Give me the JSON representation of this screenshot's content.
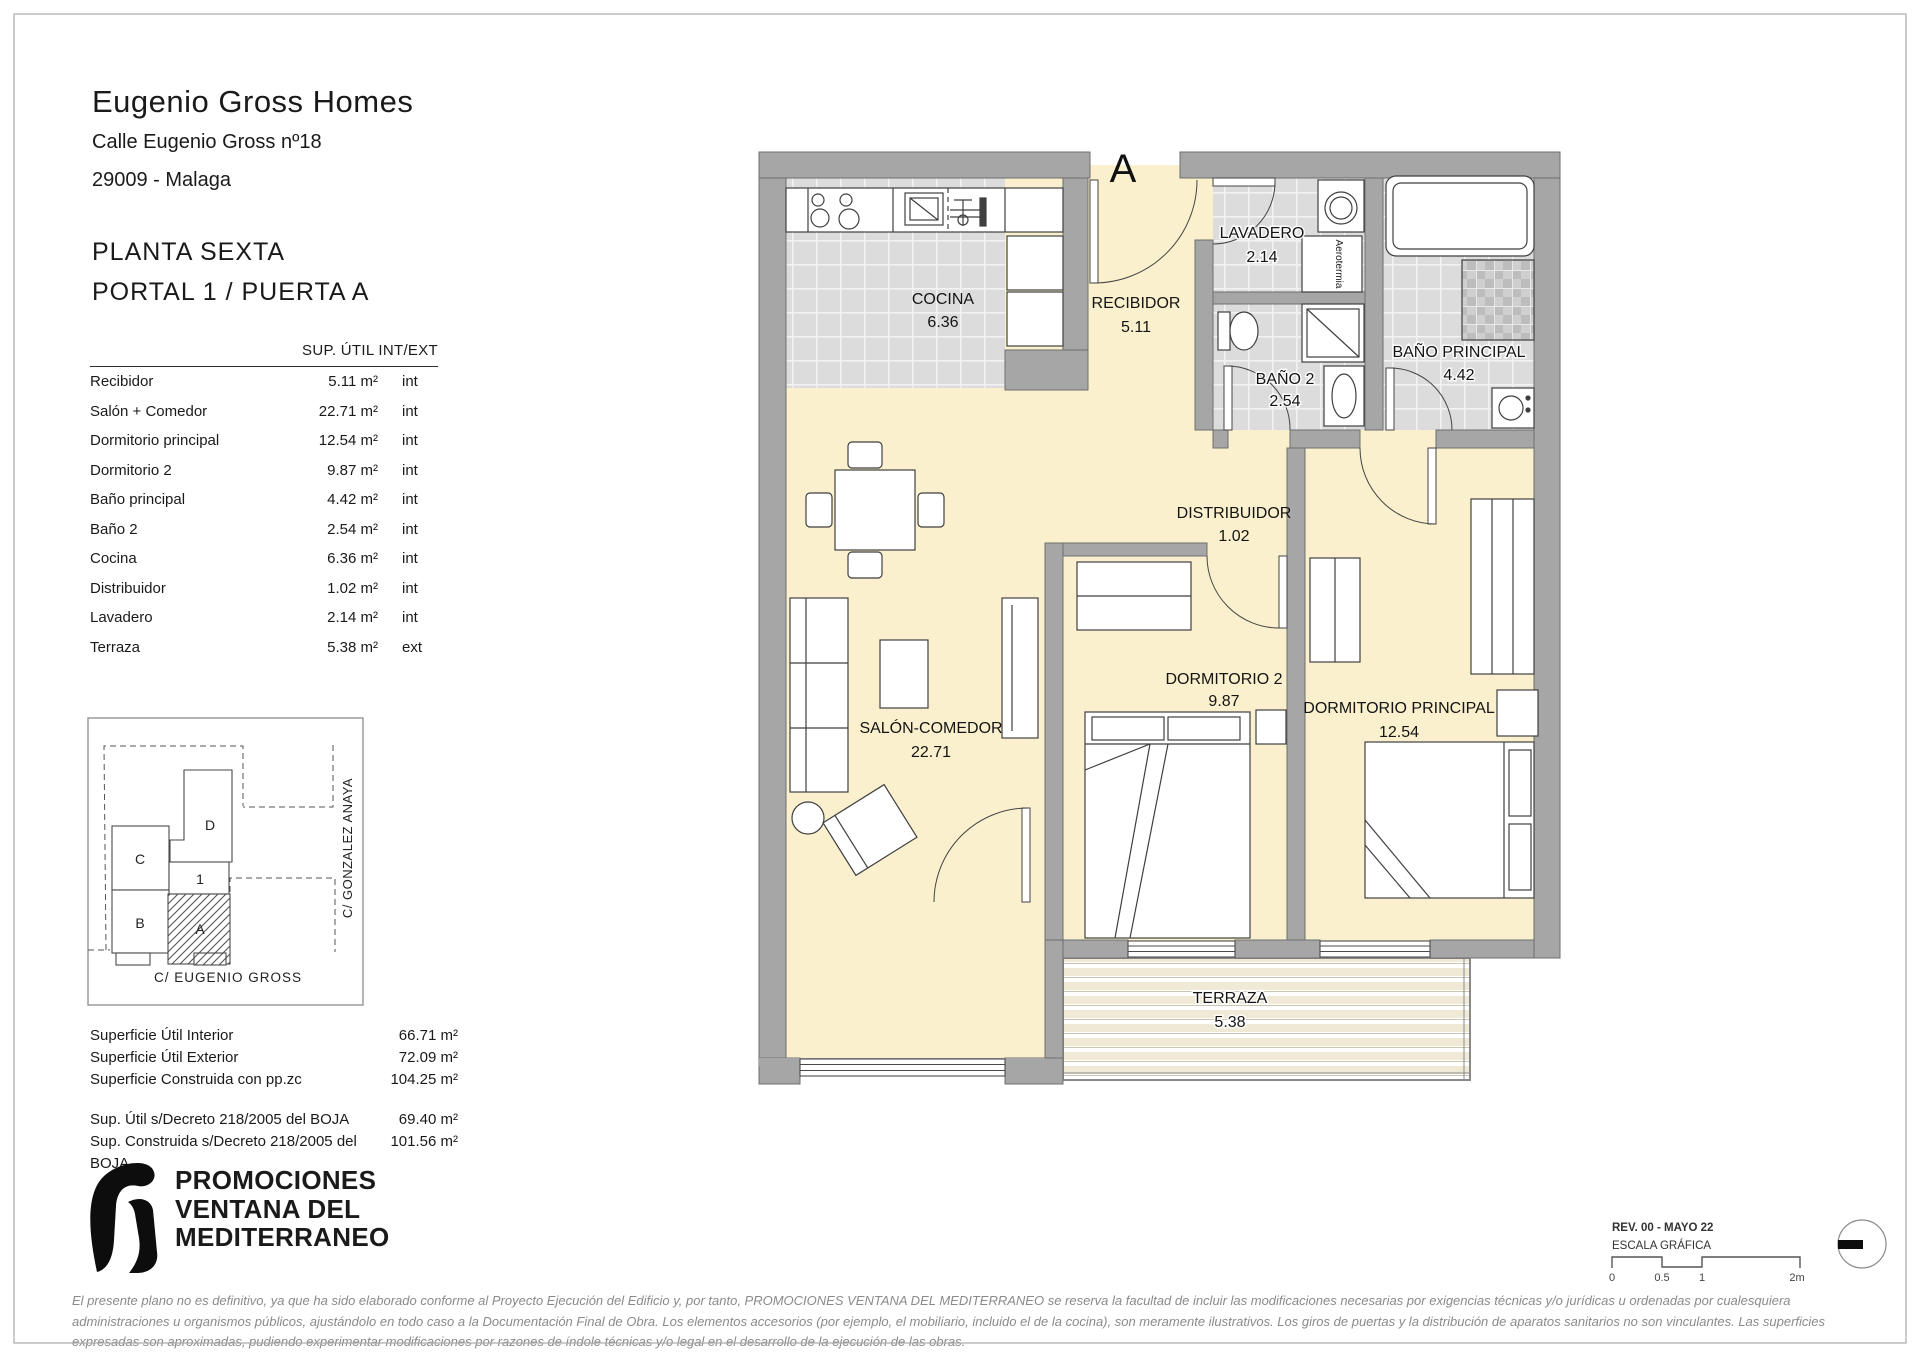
{
  "project": {
    "name": "Eugenio Gross Homes",
    "address": "Calle Eugenio Gross nº18",
    "city": "29009 - Malaga",
    "floor": "PLANTA SEXTA",
    "unit": "PORTAL 1 / PUERTA A"
  },
  "areas_table": {
    "header": "SUP. ÚTIL INT/EXT",
    "rows": [
      {
        "label": "Recibidor",
        "value": "5.11 m²",
        "type": "int"
      },
      {
        "label": "Salón + Comedor",
        "value": "22.71 m²",
        "type": "int"
      },
      {
        "label": "Dormitorio principal",
        "value": "12.54 m²",
        "type": "int"
      },
      {
        "label": "Dormitorio 2",
        "value": "9.87 m²",
        "type": "int"
      },
      {
        "label": "Baño principal",
        "value": "4.42 m²",
        "type": "int"
      },
      {
        "label": "Baño 2",
        "value": "2.54 m²",
        "type": "int"
      },
      {
        "label": "Cocina",
        "value": "6.36 m²",
        "type": "int"
      },
      {
        "label": "Distribuidor",
        "value": "1.02 m²",
        "type": "int"
      },
      {
        "label": "Lavadero",
        "value": "2.14 m²",
        "type": "int"
      },
      {
        "label": "Terraza",
        "value": "5.38 m²",
        "type": "ext"
      }
    ]
  },
  "site_plan": {
    "street_right": "C/ GONZALEZ ANAYA",
    "street_bottom": "C/ EUGENIO GROSS",
    "unit_d": "D",
    "unit_c": "C",
    "unit_1": "1",
    "unit_b": "B",
    "unit_a": "A"
  },
  "summary": {
    "rows": [
      {
        "label": "Superficie Útil Interior",
        "value": "66.71 m²"
      },
      {
        "label": "Superficie Útil Exterior",
        "value": "72.09 m²"
      },
      {
        "label": "Superficie Construida con pp.zc",
        "value": "104.25 m²"
      }
    ],
    "boja_rows": [
      {
        "label": "Sup. Útil s/Decreto 218/2005 del BOJA",
        "value": "69.40 m²"
      },
      {
        "label": "Sup. Construida s/Decreto 218/2005 del BOJA",
        "value": "101.56 m²"
      }
    ]
  },
  "developer": {
    "line1": "PROMOCIONES",
    "line2": "VENTANA DEL",
    "line3": "MEDITERRANEO"
  },
  "plan": {
    "entrance": "A",
    "aerotermia": "Aerotermia",
    "rooms": {
      "cocina": {
        "name": "COCINA",
        "area": "6.36"
      },
      "recibidor": {
        "name": "RECIBIDOR",
        "area": "5.11"
      },
      "lavadero": {
        "name": "LAVADERO",
        "area": "2.14"
      },
      "banop": {
        "name": "BAÑO PRINCIPAL",
        "area": "4.42"
      },
      "bano2": {
        "name": "BAÑO 2",
        "area": "2.54"
      },
      "distribuidor": {
        "name": "DISTRIBUIDOR",
        "area": "1.02"
      },
      "salon": {
        "name": "SALÓN-COMEDOR",
        "area": "22.71"
      },
      "dorm2": {
        "name": "DORMITORIO 2",
        "area": "9.87"
      },
      "dormp": {
        "name": "DORMITORIO PRINCIPAL",
        "area": "12.54"
      },
      "terraza": {
        "name": "TERRAZA",
        "area": "5.38"
      }
    }
  },
  "titleblock": {
    "revision": "REV. 00 - MAYO 22",
    "scale_label": "ESCALA GRÁFICA",
    "tick0": "0",
    "tick05": "0.5",
    "tick1": "1",
    "tick2": "2m"
  },
  "colors": {
    "floor_cream": "#faf0cd",
    "wall_gray": "#a6a6a6",
    "tile_gray": "#dcdcdc"
  },
  "disclaimer": "El presente plano no es definitivo, ya que ha sido elaborado conforme al Proyecto Ejecución del Edificio y, por tanto, PROMOCIONES VENTANA DEL MEDITERRANEO se reserva la facultad de incluir las modificaciones necesarias por exigencias técnicas y/o jurídicas u ordenadas por cualesquiera administraciones u organismos públicos, ajustándolo en todo caso a la Documentación Final de Obra. Los elementos accesorios (por ejemplo, el mobiliario, incluido el de la cocina), son meramente ilustrativos. Los giros de puertas y la distribución de aparatos sanitarios no son vinculantes. Las superficies expresadas son aproximadas, pudiendo experimentar modificaciones por razones de índole técnicas y/o legal en el desarrollo de la ejecución de las obras."
}
